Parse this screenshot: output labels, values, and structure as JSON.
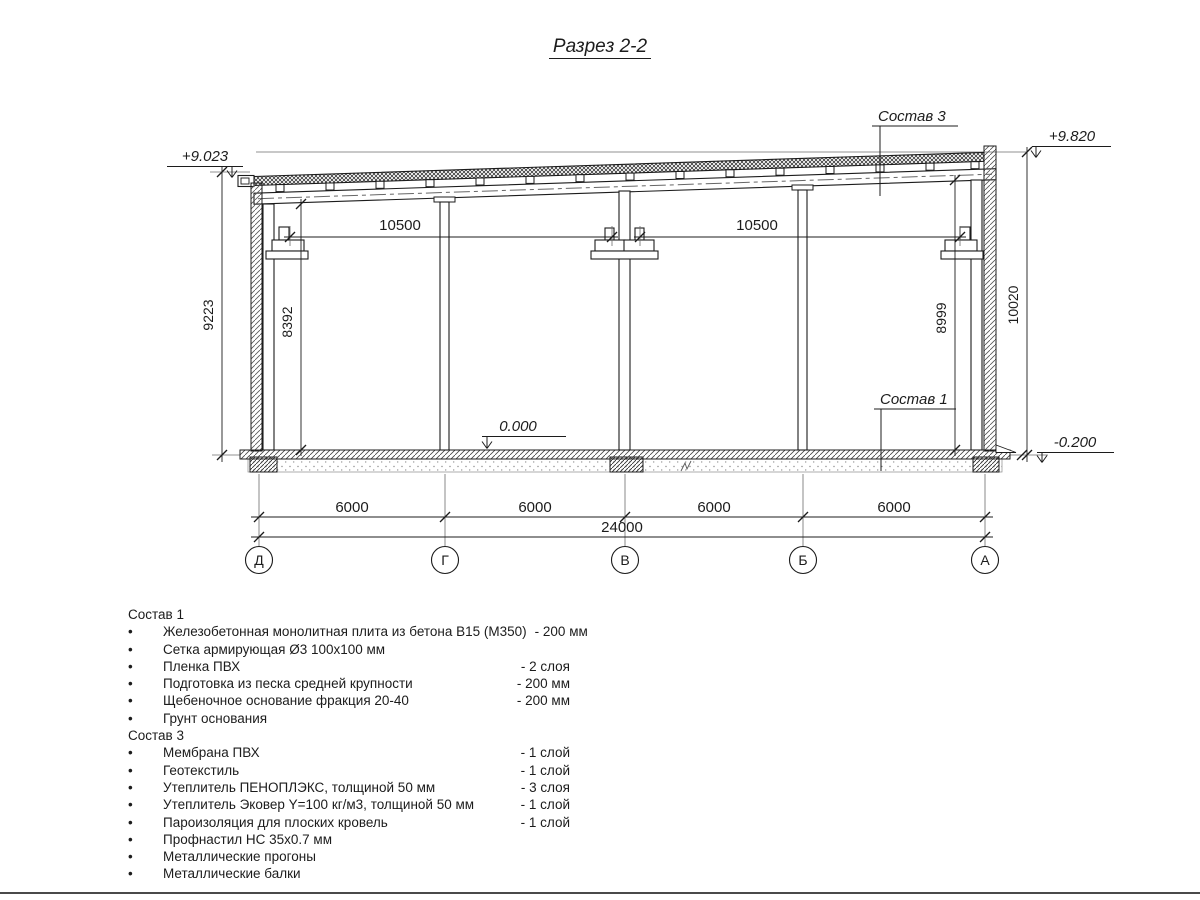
{
  "title": "Разрез 2-2",
  "drawing": {
    "elevations": {
      "top_left": "+9.023",
      "top_right": "+9.820",
      "floor": "0.000",
      "ground": "-0.200"
    },
    "callouts": {
      "roof": "Состав 3",
      "floor": "Состав 1"
    },
    "dims": {
      "span_left": "10500",
      "span_right": "10500",
      "left_outer": "9223",
      "left_inner": "8392",
      "right_inner": "8999",
      "right_outer": "10020",
      "bottom": [
        "6000",
        "6000",
        "6000",
        "6000"
      ],
      "total": "24000"
    },
    "axes": [
      "Д",
      "Г",
      "В",
      "Б",
      "А"
    ]
  },
  "legend": {
    "bullet": "•",
    "sostav1": {
      "title": "Состав 1",
      "items": [
        {
          "text": "Железобетонная монолитная плита из бетона В15 (М350)",
          "value": "-  200 мм"
        },
        {
          "text": "Сетка армирующая Ø3 100х100 мм",
          "value": ""
        },
        {
          "text": "Пленка ПВХ",
          "value": "-  2 слоя"
        },
        {
          "text": "Подготовка из песка средней крупности",
          "value": "- 200 мм"
        },
        {
          "text": "Щебеночное основание фракция 20-40",
          "value": "- 200 мм"
        },
        {
          "text": "Грунт основания",
          "value": ""
        }
      ]
    },
    "sostav3": {
      "title": "Состав 3",
      "items": [
        {
          "text": "Мембрана ПВХ",
          "value": "- 1 слой"
        },
        {
          "text": "Геотекстиль",
          "value": "- 1 слой"
        },
        {
          "text": "Утеплитель ПЕНОПЛЭКС, толщиной 50 мм",
          "value": "- 3 слоя"
        },
        {
          "text": "Утеплитель Эковер Y=100 кг/м3, толщиной 50 мм",
          "value": "- 1 слой"
        },
        {
          "text": "Пароизоляция для плоских кровель",
          "value": "- 1 слой"
        },
        {
          "text": "Профнастил НС 35х0.7 мм",
          "value": ""
        },
        {
          "text": "Металлические прогоны",
          "value": ""
        },
        {
          "text": "Металлические балки",
          "value": ""
        }
      ]
    }
  }
}
